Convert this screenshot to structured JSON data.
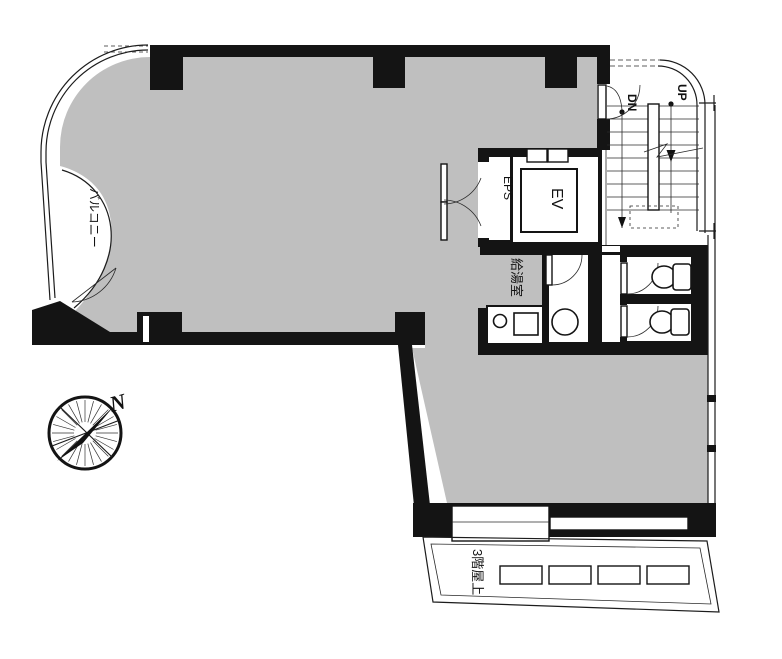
{
  "plan": {
    "labels": {
      "up": "UP",
      "dn": "DN",
      "elevator": "EV",
      "eps": "EPS",
      "kitchenette": "給湯室",
      "balcony": "バルコニー",
      "rooftop": "3階屋上",
      "north": "N"
    },
    "colors": {
      "floor_gray": "#bfbfbf",
      "wall_black": "#141414",
      "background": "#ffffff"
    },
    "stairs": {
      "tread_count": 9
    },
    "rooftop": {
      "equipment_count": 4
    }
  }
}
